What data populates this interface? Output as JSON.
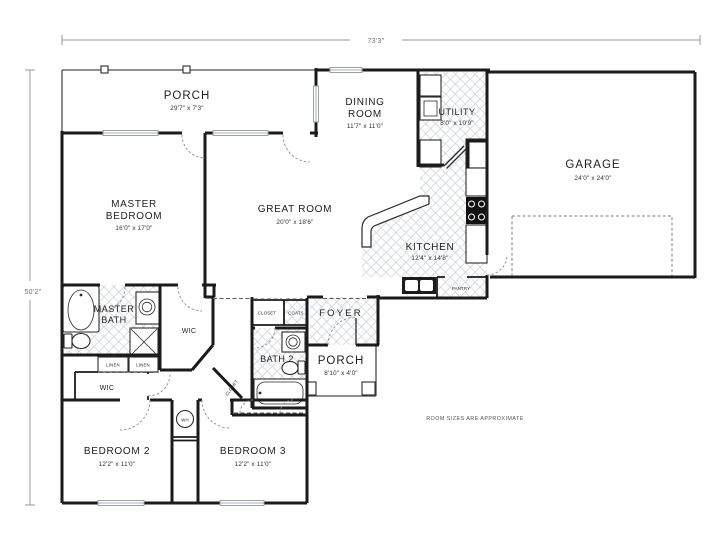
{
  "dimensions": {
    "overall_width": "73'3\"",
    "overall_height": "50'2\""
  },
  "note": "ROOM SIZES ARE APPROXIMATE",
  "colors": {
    "wall": "#1b1b1b",
    "floor_hatch": "#cfd4d8",
    "dimension_line": "#9a9a9a",
    "text": "#1e1e1e"
  },
  "rooms": {
    "porch_top": {
      "name": "PORCH",
      "dims": "29'7\" x 7'3\""
    },
    "dining_room": {
      "line1": "DINING",
      "line2": "ROOM",
      "dims": "11'7\" x 11'0\""
    },
    "utility": {
      "name": "UTILITY",
      "dims": "8'0\" x 10'9\""
    },
    "garage": {
      "name": "GARAGE",
      "dims": "24'0\" x 24'0\""
    },
    "master_bedroom": {
      "line1": "MASTER",
      "line2": "BEDROOM",
      "dims": "16'0\" x 17'0\""
    },
    "great_room": {
      "name": "GREAT ROOM",
      "dims": "20'0\" x 18'6\""
    },
    "kitchen": {
      "name": "KITCHEN",
      "dims": "12'4\" x 14'8\""
    },
    "pantry": {
      "name": "PANTRY"
    },
    "master_bath": {
      "line1": "MASTER",
      "line2": "BATH"
    },
    "wic_master": {
      "name": "WIC"
    },
    "closet_hall": {
      "name": "CLOSET"
    },
    "coats": {
      "name": "COATS"
    },
    "foyer": {
      "name": "FOYER"
    },
    "bath2": {
      "name": "BATH 2"
    },
    "porch_front": {
      "name": "PORCH",
      "dims": "8'10\" x 4'0\""
    },
    "linen1": {
      "name": "LINEN"
    },
    "linen2": {
      "name": "LINEN"
    },
    "wic2": {
      "name": "WIC"
    },
    "closet_diag": {
      "name": "CLOSET"
    },
    "water_heater": {
      "name": "WH"
    },
    "bedroom2": {
      "name": "BEDROOM 2",
      "dims": "12'2\" x 11'0\""
    },
    "bedroom3": {
      "name": "BEDROOM 3",
      "dims": "12'2\" x 11'0\""
    }
  }
}
